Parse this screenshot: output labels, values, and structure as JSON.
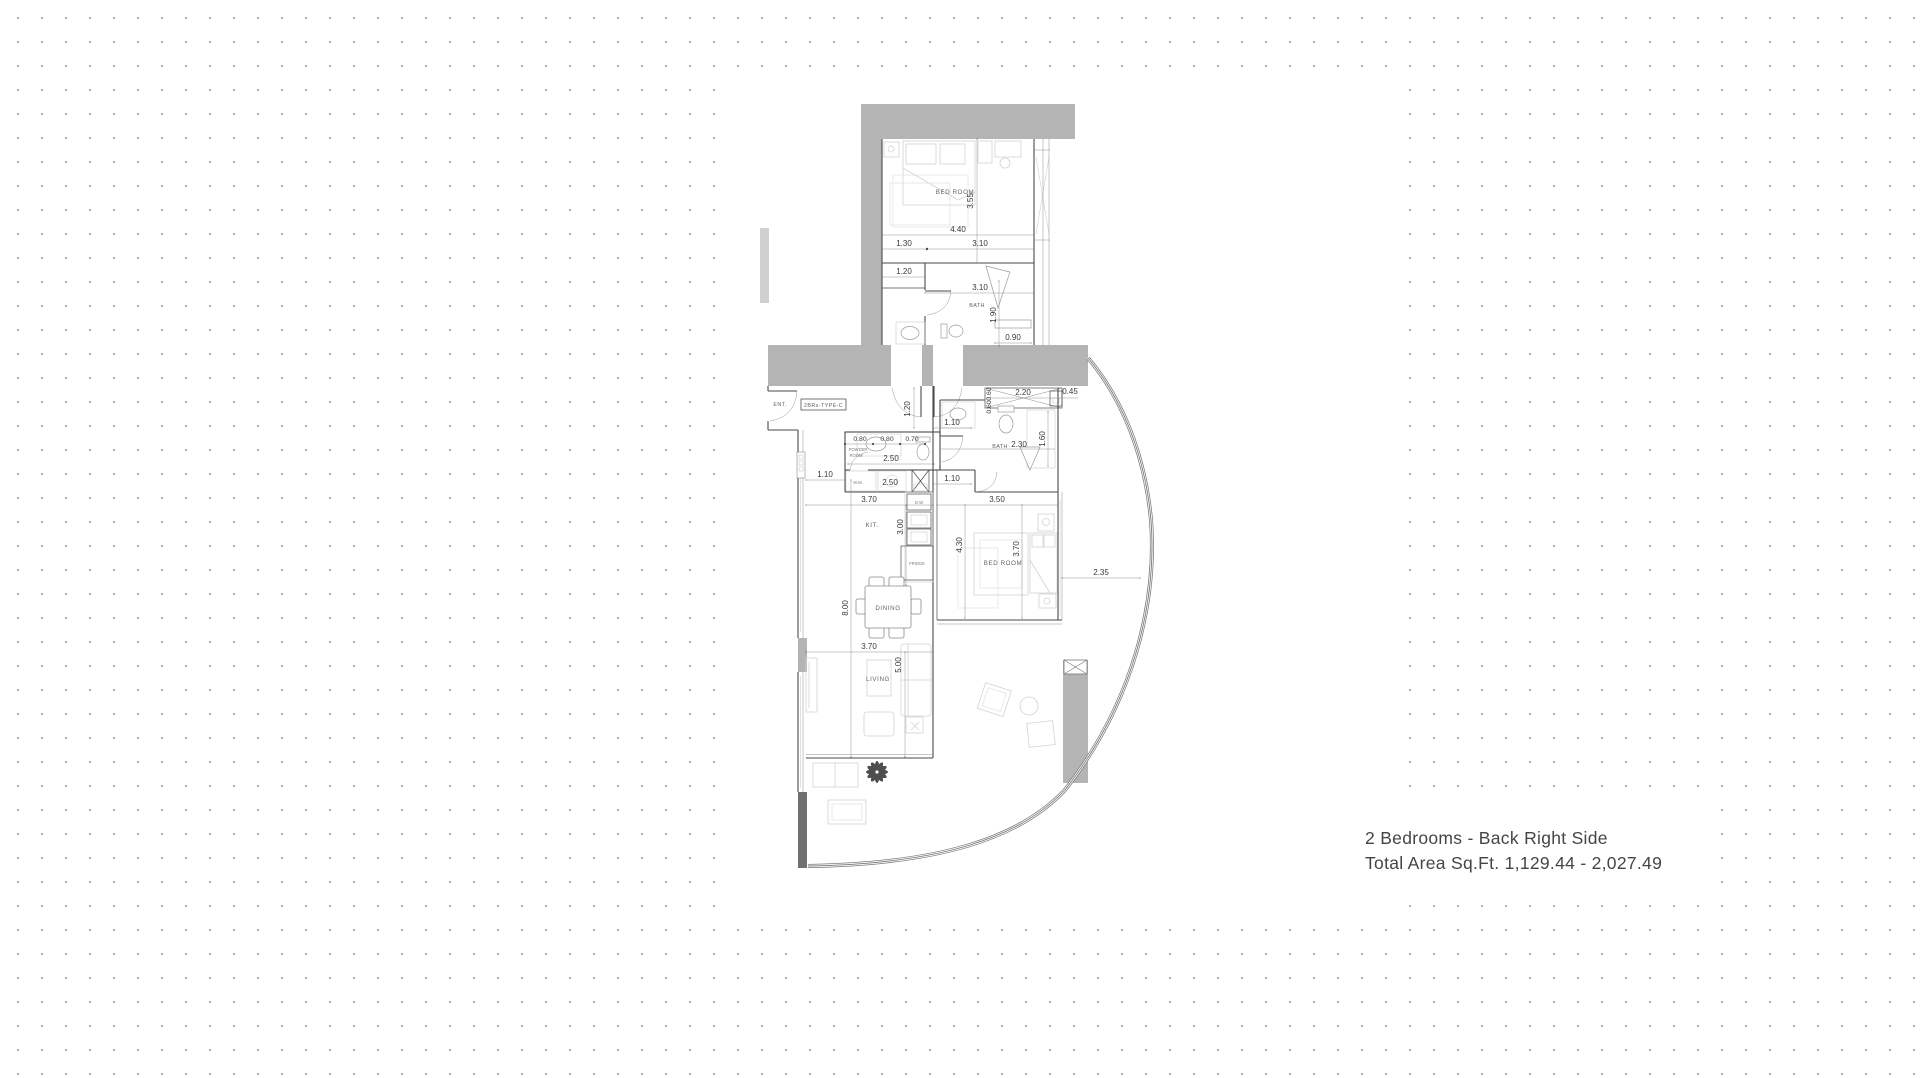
{
  "caption": {
    "line1": "2 Bedrooms - Back Right Side",
    "line2": "Total Area Sq.Ft. 1,129.44 - 2,027.49"
  },
  "plan": {
    "type_label": "2BRs-TYPE-C",
    "labels": {
      "ent": "ENT.",
      "bedroom1": "BED ROOM",
      "bath1": "BATH",
      "powder1": "POWDER",
      "powder2": "ROOM",
      "wm": "W.M.",
      "dw": "D.W",
      "kit": "KIT.",
      "fridge": "FRIDGE",
      "dining": "DINING",
      "living": "LIVING",
      "bath2": "BATH",
      "bedroom2": "BED ROOM"
    },
    "dims": {
      "d440": "4.40",
      "d130": "1.30",
      "d310a": "3.10",
      "d355": "3.55",
      "d120a": "1.20",
      "d310b": "3.10",
      "d190": "1.90",
      "d090": "0.90",
      "d120b": "1.20",
      "d110a": "1.10",
      "d060a": "0.60",
      "d060b": "0.60",
      "d220": "2.20",
      "d045": "0.45",
      "d230": "2.30",
      "d160": "1.60",
      "d080a": "0.80",
      "d080b": "0.80",
      "d070": "0.70",
      "d250a": "2.50",
      "d250b": "2.50",
      "d110b": "1.10",
      "d110c": "1.10",
      "d370a": "3.70",
      "d350": "3.50",
      "d300": "3.00",
      "d430": "4.30",
      "d370b": "3.70",
      "d235": "2.35",
      "d800": "8.00",
      "d370c": "3.70",
      "d500": "5.00"
    },
    "colors": {
      "wall_gray": "#b4b4b4",
      "wall_dark": "#6f6f6f",
      "dot_grid": "#b9b9b9",
      "caption_text": "#454545"
    }
  }
}
